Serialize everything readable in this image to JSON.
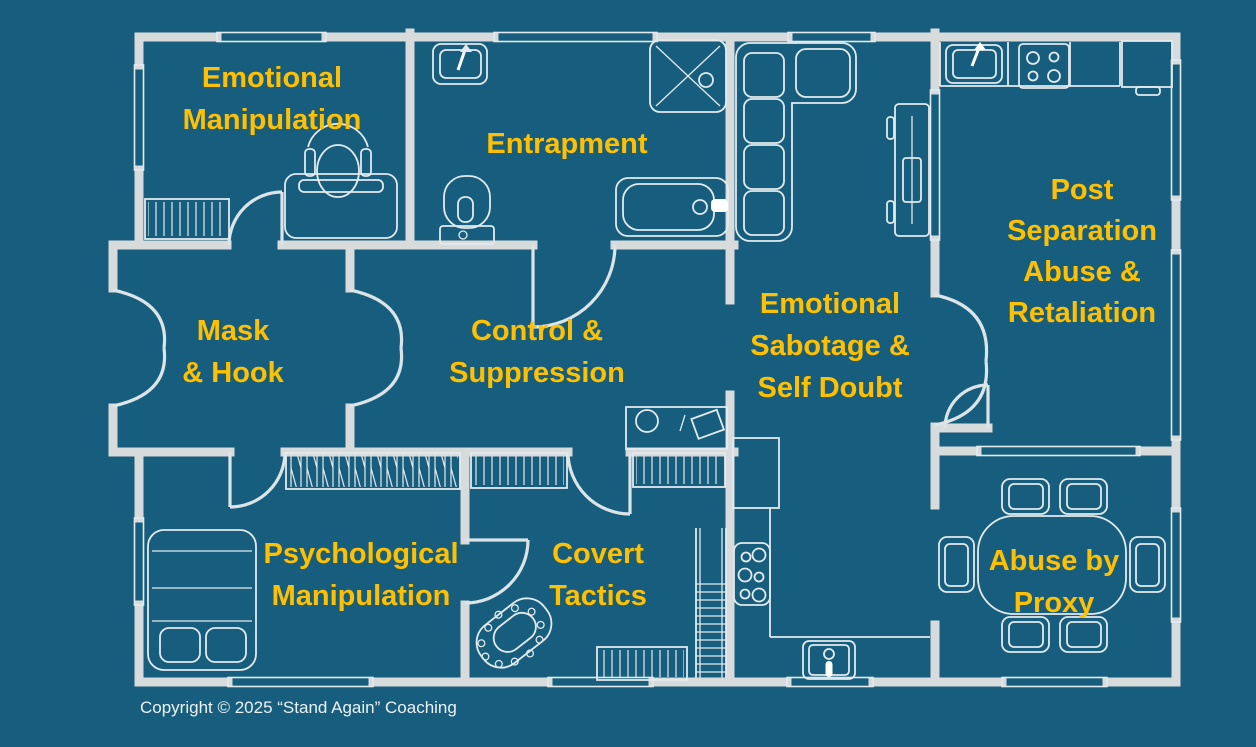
{
  "colors": {
    "background": "#175E7E",
    "walls": "#D8DBDB",
    "furniture": "#E3EAED",
    "doors": "#DCE4E7",
    "label": "#FFC000",
    "copyright": "#ECF1F2"
  },
  "diagram": {
    "type": "floor-plan",
    "description": "House floor plan where each room is labeled with an abusive-relationship tactic"
  },
  "rooms": [
    {
      "id": "emotional-manipulation",
      "label": "Emotional Manipulation",
      "lines": [
        "Emotional",
        "Manipulation"
      ],
      "furniture": [
        "radiator-icon",
        "office-chair-icon",
        "desk-icon"
      ]
    },
    {
      "id": "entrapment",
      "label": "Entrapment",
      "lines": [
        "Entrapment"
      ],
      "furniture": [
        "sink-icon",
        "toilet-icon",
        "shower-icon",
        "bathtub-icon"
      ]
    },
    {
      "id": "post-separation-abuse-retaliation",
      "label": "Post Separation Abuse & Retaliation",
      "lines": [
        "Post",
        "Separation",
        "Abuse &",
        "Retaliation"
      ],
      "furniture": [
        "kitchen-sink-icon",
        "stove-icon",
        "fridge-icon",
        "counter-icon"
      ]
    },
    {
      "id": "mask-and-hook",
      "label": "Mask & Hook",
      "lines": [
        "Mask",
        "& Hook"
      ],
      "furniture": []
    },
    {
      "id": "control-suppression",
      "label": "Control & Suppression",
      "lines": [
        "Control &",
        "Suppression"
      ],
      "furniture": [
        "desk-icon",
        "wardrobe-icon"
      ]
    },
    {
      "id": "emotional-sabotage-self-doubt",
      "label": "Emotional Sabotage & Self Doubt",
      "lines": [
        "Emotional",
        "Sabotage &",
        "Self Doubt"
      ],
      "furniture": [
        "sofa-icon",
        "tv-unit-icon"
      ]
    },
    {
      "id": "psychological-manipulation",
      "label": "Psychological Manipulation",
      "lines": [
        "Psychological",
        "Manipulation"
      ],
      "furniture": [
        "bed-icon"
      ]
    },
    {
      "id": "covert-tactics",
      "label": "Covert Tactics",
      "lines": [
        "Covert",
        "Tactics"
      ],
      "furniture": [
        "small-table-icon",
        "stairs-icon",
        "radiator-icon"
      ]
    },
    {
      "id": "abuse-by-proxy",
      "label": "Abuse by Proxy",
      "lines": [
        "Abuse by",
        "Proxy"
      ],
      "furniture": [
        "dining-table-icon",
        "chair-icon"
      ]
    }
  ],
  "footer": {
    "copyright": "Copyright © 2025 “Stand Again” Coaching"
  }
}
